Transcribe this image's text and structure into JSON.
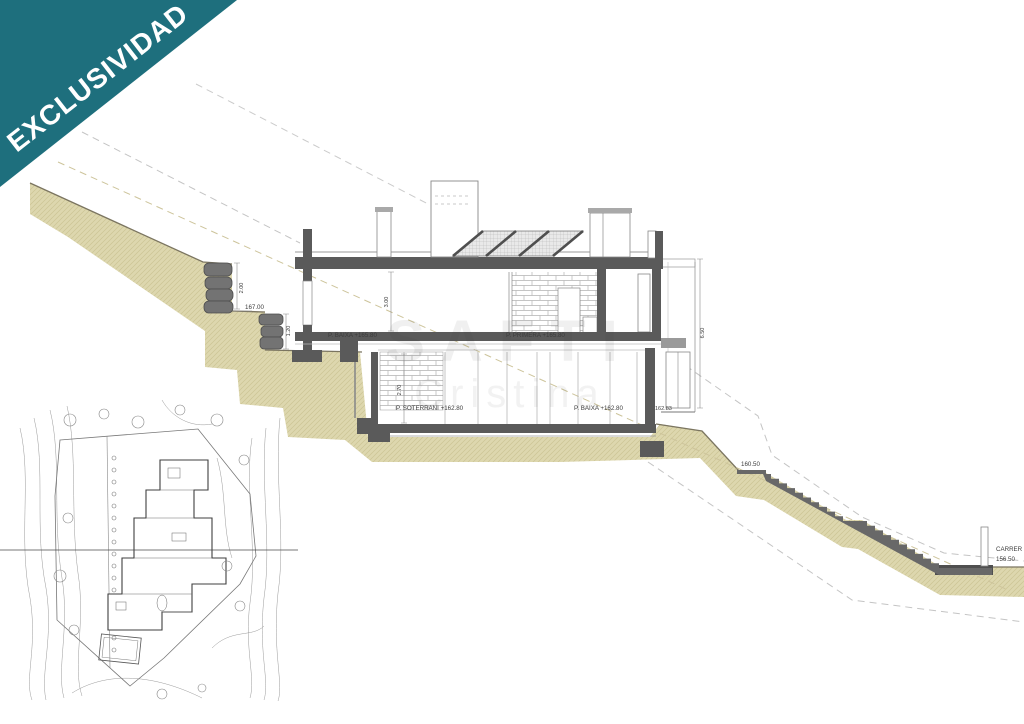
{
  "banner": {
    "label": "EXCLUSIVIDAD",
    "color": "#1e6f7d"
  },
  "watermark": {
    "line1": "SAFTI",
    "line2": "Cristina"
  },
  "section": {
    "floors": {
      "baixa_upper": "P. BAIXA +165.80",
      "primera": "P. PRIMERA +165.80",
      "soterrani": "P. SOTERRANI +162.80",
      "baixa_lower": "P. BAIXA +162.80"
    },
    "elevations": {
      "terrace": "167.00",
      "slope_mid": "160.50",
      "annex_base": "162.83",
      "street_name": "CARRER",
      "street_level": "156.50"
    },
    "dims": {
      "rockwall_upper": "2.00",
      "rockwall_lower": "1.20",
      "upper_height": "3.00",
      "lower_height": "2.70",
      "annex_height": "6.50"
    }
  },
  "colors": {
    "ribbon_teal": "#1e6f7d",
    "terrain_tan": "#ddd7ae",
    "structure_gray": "#5a5a5a"
  }
}
